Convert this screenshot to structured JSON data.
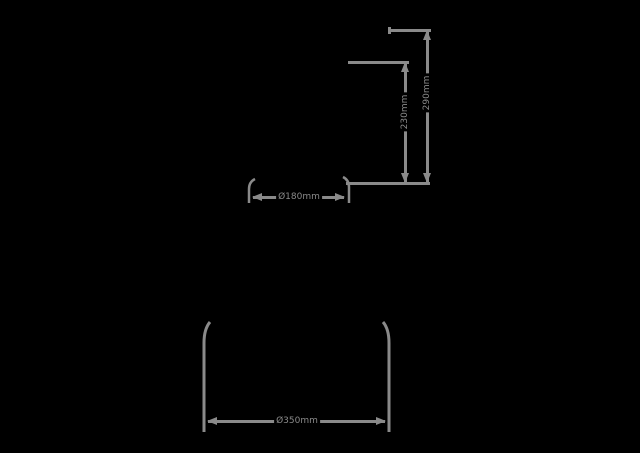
{
  "page": {
    "background_color": "#000000",
    "line_color": "#8a8a8a"
  },
  "diagram": {
    "type": "dimension-drawing",
    "dimensions": [
      {
        "id": "overall-height",
        "orientation": "vertical",
        "label": "290mm"
      },
      {
        "id": "partial-height",
        "orientation": "vertical",
        "label": "230mm"
      },
      {
        "id": "top-diameter",
        "orientation": "horizontal",
        "label": "Ø180mm"
      },
      {
        "id": "bottom-diameter",
        "orientation": "horizontal",
        "label": "Ø350mm"
      }
    ]
  }
}
